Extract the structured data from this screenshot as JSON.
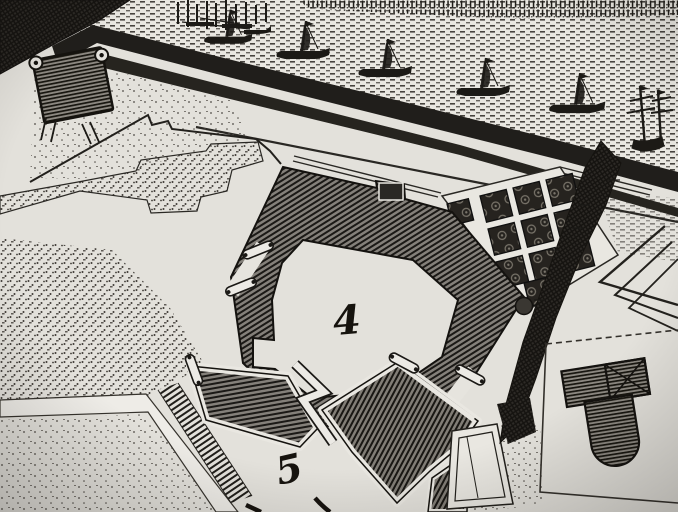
{
  "image_type": "photograph of an engraved 17th-century fortification map",
  "labels": {
    "fort_main": "4",
    "fort_outwork": "5"
  },
  "map_numerals": [
    "4",
    "5"
  ],
  "features": {
    "sea": "stippled harbor water with sailing ships",
    "ships_count": 6,
    "shoreline": "dark diagonal quay and berm bands",
    "redoubt": "small square redoubt with corner turrets (upper left)",
    "main_fort": "pentagonal bastioned fort with hatched rampart and light courtyard",
    "garden_parterre": "grid of ornamental garden plots (upper right)",
    "garden_plots_count": 11,
    "scrub_band": "dark vegetation strip right of the fort",
    "ravelin_outline": "nested chevron outlines at right edge",
    "keyhole_building": "T-shaped hatched structure in outlined plot (lower right)",
    "zigzag_passage": "zigzag gap between lower rampart segments",
    "roads": "light roads with thin engraved edges",
    "glacis": "stippled ground textures"
  },
  "palette": {
    "paper": "#e3e1db",
    "road_light": "#eeece7",
    "ink": "#14120f",
    "wall_base": "#84807a",
    "shore_dark": "#201e1b",
    "stipple": "#3e3a35"
  }
}
